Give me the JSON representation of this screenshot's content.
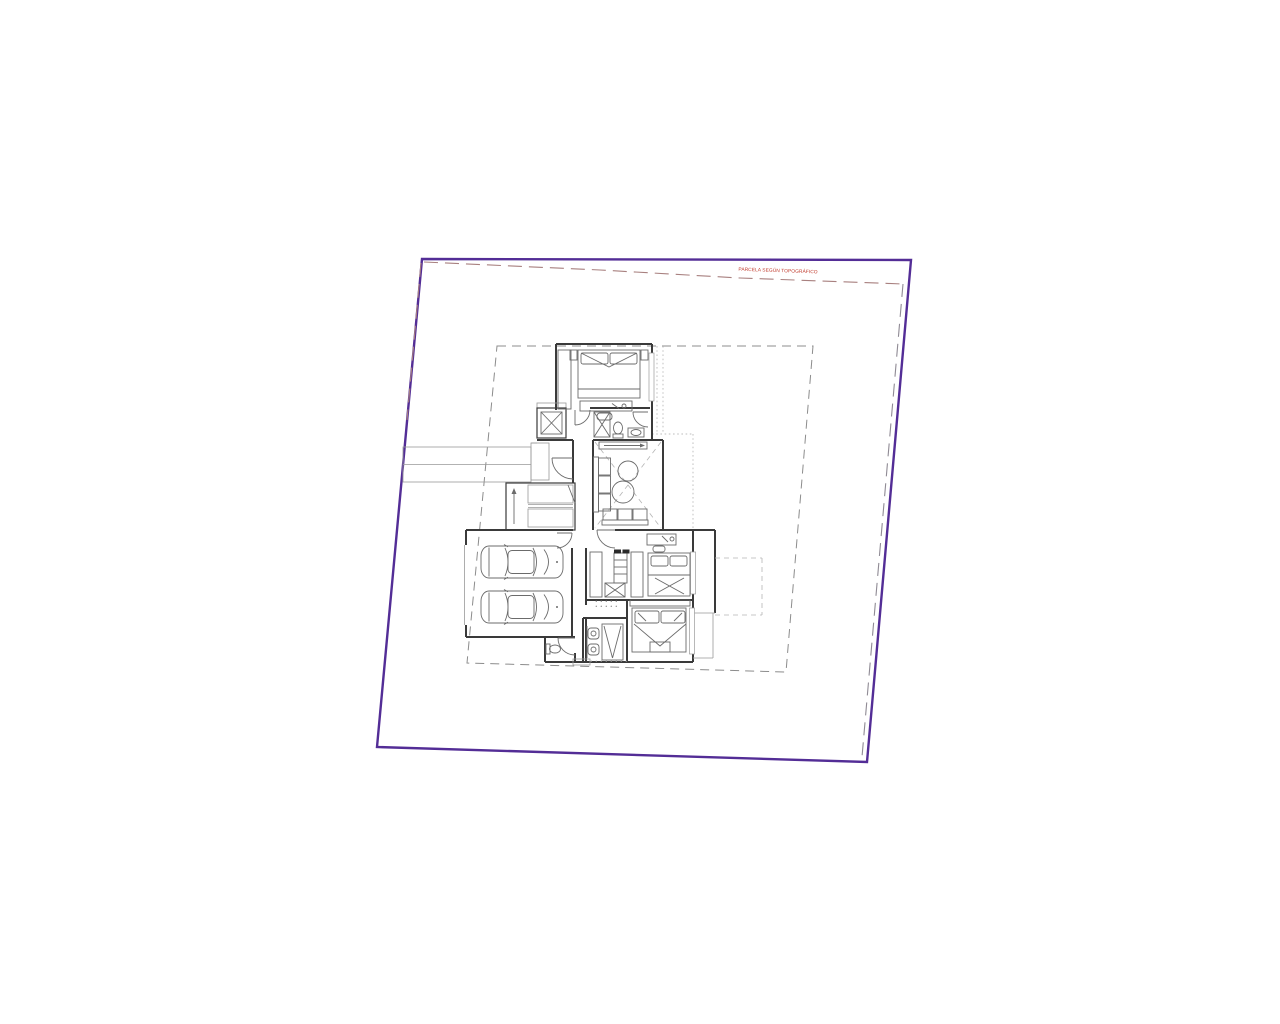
{
  "page": {
    "background": "#ffffff"
  },
  "annotations": {
    "parcel_note": "PARCELA SEGÚN TOPOGRÁFICO"
  },
  "colors": {
    "plot_boundary": "#532d96",
    "parcel_dashed": "#a8807f",
    "survey_dashed": "#8f8a94",
    "setback_dashed": "#8c8c8c",
    "annotation_red": "#c0392b",
    "wall": "#3a3a3a",
    "furniture": "#6b6b6b",
    "light_detail": "#999999"
  }
}
